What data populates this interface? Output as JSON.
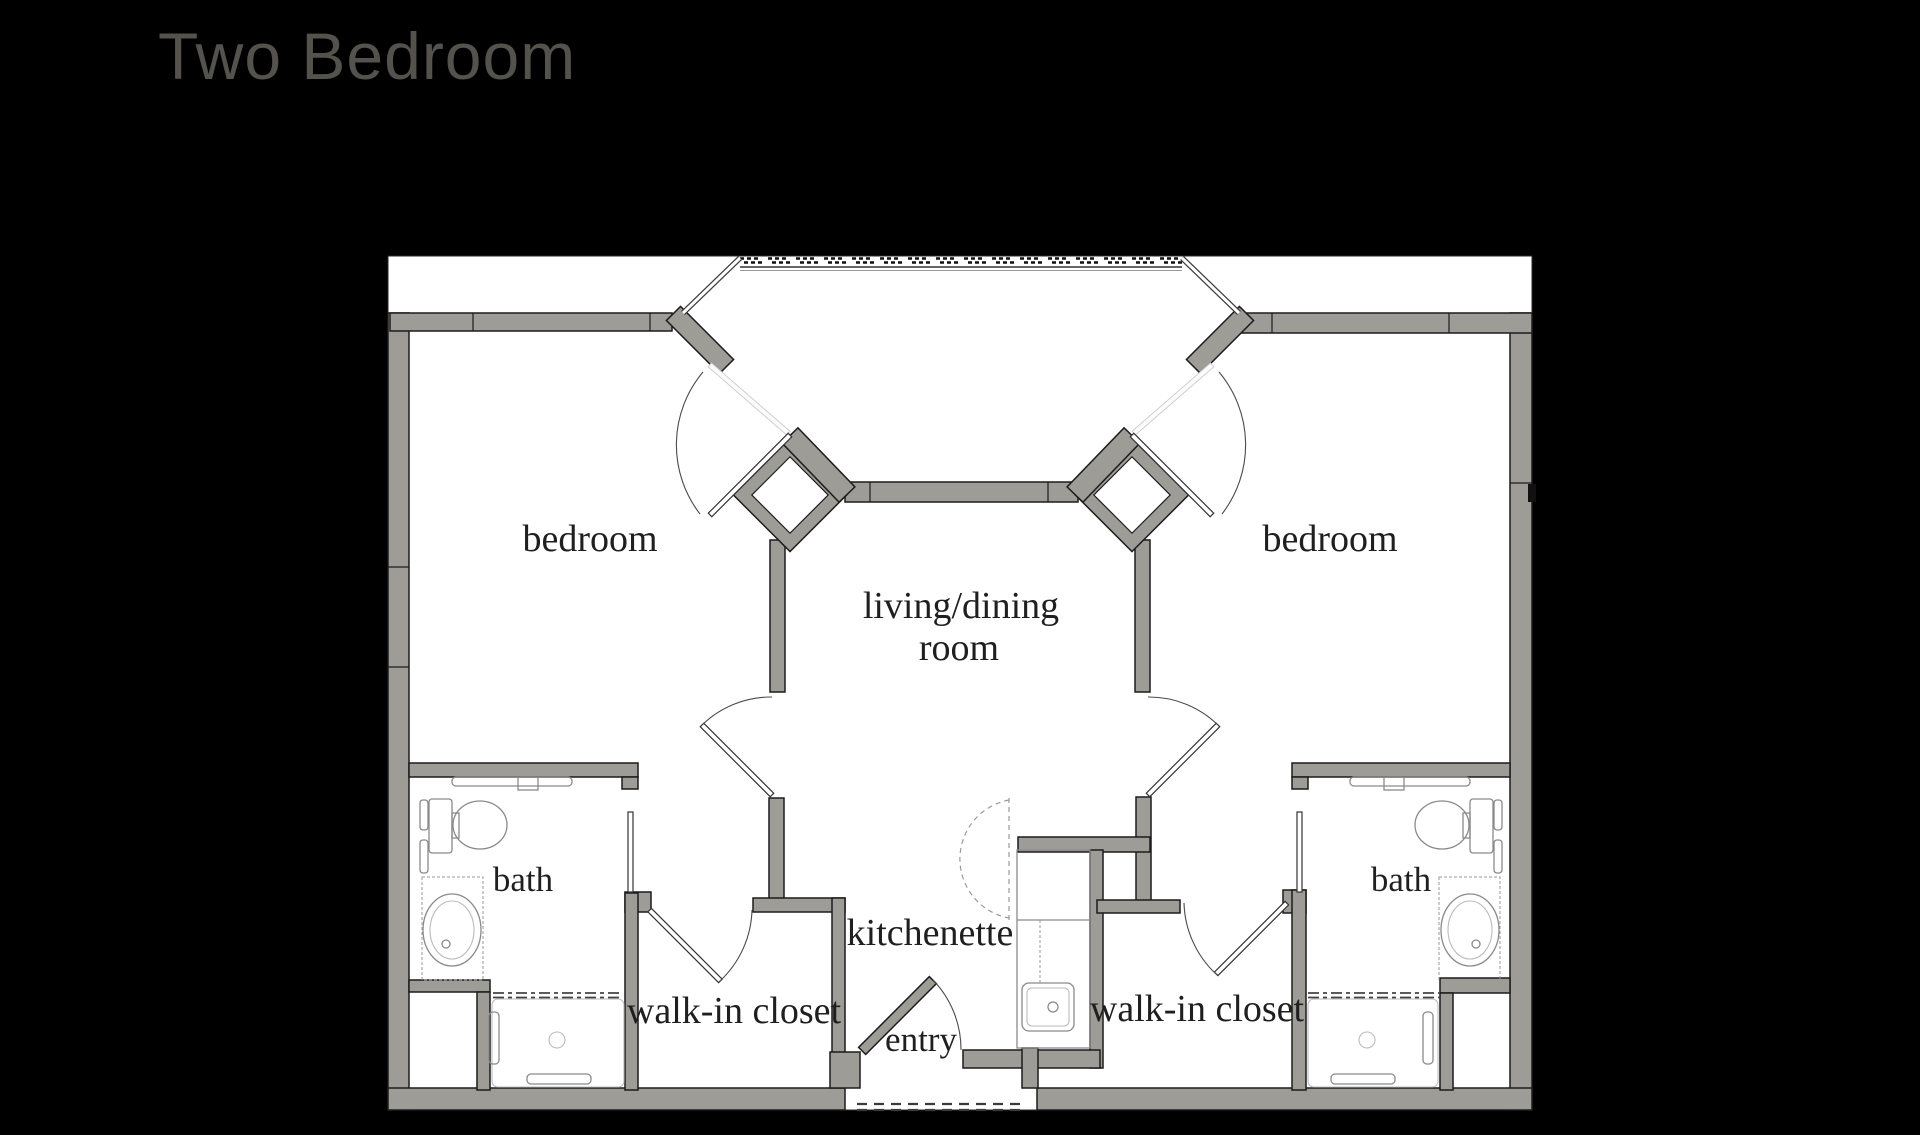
{
  "title": "Two Bedroom",
  "theme": {
    "background": "#000000",
    "floor": "#ffffff",
    "wall_fill": "#9e9c97",
    "wall_line": "#1c1c1c",
    "fixture_line": "#8a8a8a",
    "title_color": "#54524c",
    "label_color": "#1f1f1f"
  },
  "labels": {
    "bedroom_left": "bedroom",
    "bedroom_right": "bedroom",
    "living_line1": "living/dining",
    "living_line2": "room",
    "bath_left": "bath",
    "bath_right": "bath",
    "closet_left": "walk-in closet",
    "closet_right": "walk-in closet",
    "kitchenette": "kitchenette",
    "entry": "entry"
  }
}
